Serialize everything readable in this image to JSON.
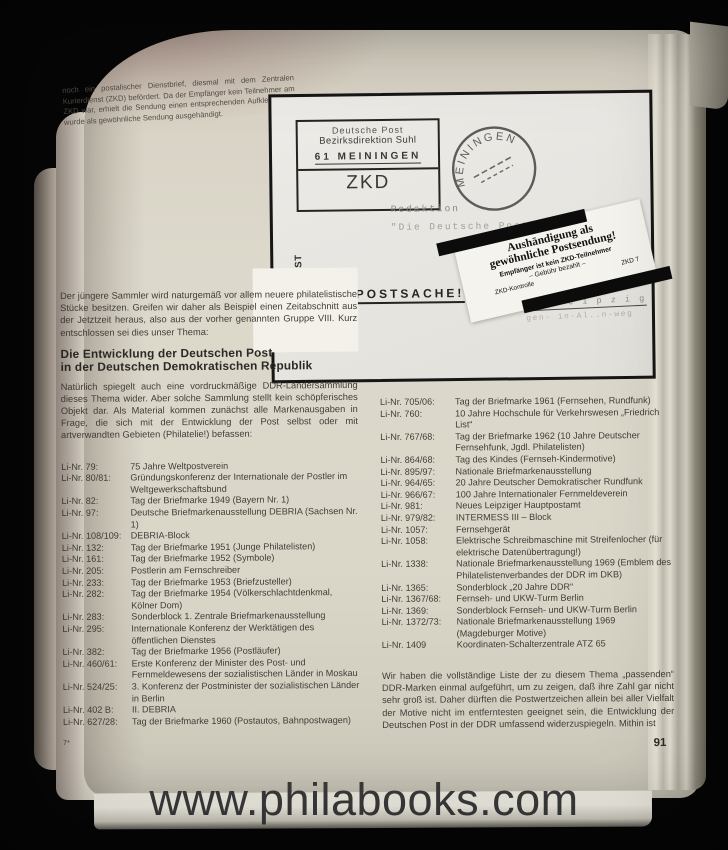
{
  "watermark": "www.philabooks.com",
  "page": {
    "number": "91",
    "signature_mark": "7*"
  },
  "caption": "noch ein postalischer Dienstbrief, diesmal mit dem Zentralen Kurierdienst (ZKD) befördert. Da der Empfänger kein Teilnehmer am ZKD war, erhielt die Sendung einen entsprechenden Aufkleber und wurde als gewöhnliche Sendung ausgehändigt.",
  "envelope": {
    "cachet_box": {
      "line1": "Deutsche Post",
      "line2": "Bezirksdirektion Suhl",
      "line3": "61 MEININGEN",
      "line4": "ZKD"
    },
    "sender_vertical": {
      "line1": "DEUTSCHE POST",
      "line2": "Bezirksdirektion Suhl",
      "line3": "Sitz: 61 Meiningen"
    },
    "postmark": "MEININGEN",
    "address": {
      "line1": "Redaktion",
      "line2": "\"Die Deutsche Post\""
    },
    "label": {
      "line1": "Aushändigung als",
      "line2": "gewöhnliche Postsendung!",
      "line3": "Empfänger ist kein ZKD-Teilnehmer",
      "line4": "–  Gebühr bezahlt  –",
      "line5": "ZKD-Kontrolle",
      "line6": "ZKD 7"
    },
    "postsache": "POSTSACHE!",
    "typed_line1": "705 L e i p z i g",
    "typed_line2": "gen-  in-Al..n-weg"
  },
  "intro": "Der jüngere Sammler wird naturgemäß vor allem neuere philatelistische Stücke besitzen. Greifen wir daher als Beispiel einen Zeitabschnitt aus der Jetztzeit heraus, also aus der vorher genannten Gruppe VIII. Kurz entschlossen sei dies unser Thema:",
  "heading": {
    "line1": "Die Entwicklung der Deutschen Post",
    "line2": "in der Deutschen Demokratischen Republik"
  },
  "lead": "Natürlich spiegelt auch eine vordruckmäßige DDR-Ländersammlung dieses Thema wider. Aber solche Sammlung stellt kein schöpferisches Objekt dar. Als Material kommen zunächst alle Markenausgaben in Frage, die sich mit der Entwicklung der Post selbst oder mit artverwandten Gebieten (Philatelie!) befassen:",
  "list_left": [
    {
      "nr": "Li-Nr. 79:",
      "text": "75 Jahre Weltpostverein"
    },
    {
      "nr": "Li-Nr. 80/81:",
      "text": "Gründungskonferenz der Internationale der Postler im Weltgewerkschaftsbund"
    },
    {
      "nr": "Li-Nr. 82:",
      "text": "Tag der Briefmarke 1949 (Bayern Nr. 1)"
    },
    {
      "nr": "Li-Nr. 97:",
      "text": "Deutsche Briefmarkenausstellung DEBRIA (Sachsen Nr. 1)"
    },
    {
      "nr": "Li-Nr. 108/109:",
      "text": "DEBRIA-Block"
    },
    {
      "nr": "Li-Nr. 132:",
      "text": "Tag der Briefmarke 1951 (Junge Philatelisten)"
    },
    {
      "nr": "Li-Nr. 161:",
      "text": "Tag der Briefmarke 1952 (Symbole)"
    },
    {
      "nr": "Li-Nr. 205:",
      "text": "Postlerin am Fernschreiber"
    },
    {
      "nr": "Li-Nr. 233:",
      "text": "Tag der Briefmarke 1953 (Briefzusteller)"
    },
    {
      "nr": "Li-Nr. 282:",
      "text": "Tag der Briefmarke 1954 (Völkerschlachtdenkmal, Kölner Dom)"
    },
    {
      "nr": "Li-Nr. 283:",
      "text": "Sonderblock 1. Zentrale Briefmarkenausstellung"
    },
    {
      "nr": "Li-Nr. 295:",
      "text": "Internationale Konferenz der Werktätigen des öffentlichen Dienstes"
    },
    {
      "nr": "Li-Nr. 382:",
      "text": "Tag der Briefmarke 1956 (Postläufer)"
    },
    {
      "nr": "Li-Nr. 460/61:",
      "text": "Erste Konferenz der Minister des Post- und Fernmeldewesens der sozialistischen Länder in Moskau"
    },
    {
      "nr": "Li-Nr. 524/25:",
      "text": "3. Konferenz der Postminister der sozialistischen Länder in Berlin"
    },
    {
      "nr": "Li-Nr. 402 B:",
      "text": "II. DEBRIA"
    },
    {
      "nr": "Li-Nr. 627/28:",
      "text": "Tag der Briefmarke 1960 (Postautos, Bahnpostwagen)"
    }
  ],
  "list_right": [
    {
      "nr": "Li-Nr. 705/06:",
      "text": "Tag der Briefmarke 1961 (Fernsehen, Rundfunk)"
    },
    {
      "nr": "Li-Nr. 760:",
      "text": "10 Jahre Hochschule für Verkehrswesen „Friedrich List“"
    },
    {
      "nr": "Li-Nr. 767/68:",
      "text": "Tag der Briefmarke 1962 (10 Jahre Deutscher Fernsehfunk, Jgdl. Philatelisten)"
    },
    {
      "nr": "Li-Nr. 864/68:",
      "text": "Tag des Kindes (Fernseh-Kindermotive)"
    },
    {
      "nr": "Li-Nr. 895/97:",
      "text": "Nationale Briefmarkenausstellung"
    },
    {
      "nr": "Li-Nr. 964/65:",
      "text": "20 Jahre Deutscher Demokratischer Rundfunk"
    },
    {
      "nr": "Li-Nr. 966/67:",
      "text": "100 Jahre Internationaler Fernmeldeverein"
    },
    {
      "nr": "Li-Nr. 981:",
      "text": "Neues Leipziger Hauptpostamt"
    },
    {
      "nr": "Li-Nr. 979/82:",
      "text": "INTERMESS III – Block"
    },
    {
      "nr": "Li-Nr. 1057:",
      "text": "Fernsehgerät"
    },
    {
      "nr": "Li-Nr. 1058:",
      "text": "Elektrische Schreibmaschine mit Streifenlocher (für elektrische Datenübertragung!)"
    },
    {
      "nr": "Li-Nr. 1338:",
      "text": "Nationale Briefmarkenausstellung 1969 (Emblem des Philatelistenverbandes der DDR im DKB)"
    },
    {
      "nr": "Li-Nr. 1365:",
      "text": "Sonderblock „20 Jahre DDR“"
    },
    {
      "nr": "Li-Nr. 1367/68:",
      "text": "Fernseh- und UKW-Turm Berlin"
    },
    {
      "nr": "Li-Nr. 1369:",
      "text": "Sonderblock Fernseh- und UKW-Turm Berlin"
    },
    {
      "nr": "Li-Nr. 1372/73:",
      "text": "Nationale Briefmarkenausstellung 1969 (Magdeburger Motive)"
    },
    {
      "nr": "Li-Nr. 1409",
      "text": "Koordinaten-Schalterzentrale ATZ 65"
    }
  ],
  "closing": "Wir haben die vollständige Liste der zu diesem Thema „passenden“ DDR-Marken einmal aufgeführt, um zu zeigen, daß ihre Zahl gar nicht sehr groß ist. Daher dürften die Postwertzeichen allein bei aller Vielfalt der Motive nicht im entferntesten geeignet sein, die Entwicklung der Deutschen Post in der DDR umfassend widerzuspiegeln. Mithin ist"
}
